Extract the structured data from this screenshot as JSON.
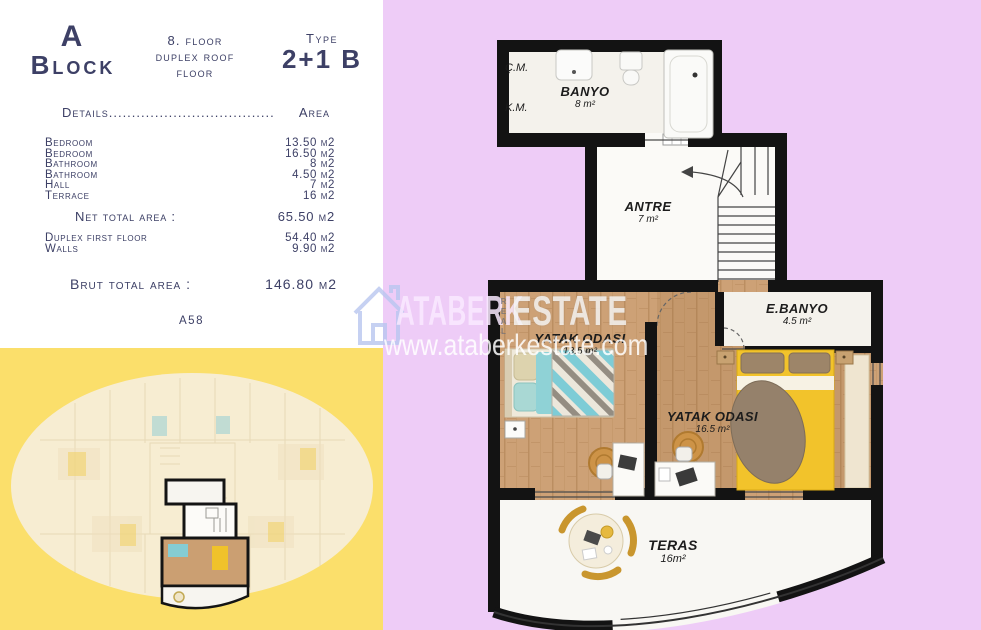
{
  "colors": {
    "background_purple": "#eeccf7",
    "background_yellow": "#fbdf6b",
    "panel_text_navy": "#3d4066",
    "wall_black": "#131313",
    "wood_floor": "#cda176",
    "bed_yellow": "#f2c32b",
    "bed_teal": "#7eccd6",
    "rug_tan": "#cd9347"
  },
  "info_panel": {
    "block_line1": "A",
    "block_line2": "Block",
    "floor_lines": [
      "8. floor",
      "duplex roof",
      "floor"
    ],
    "type_label": "Type",
    "type_value": "2+1 B",
    "details_label": "Details....................................",
    "area_label": "Area",
    "area_rows": [
      {
        "label": "Bedroom",
        "value": "13.50 m2"
      },
      {
        "label": "Bedroom",
        "value": "16.50 m2"
      },
      {
        "label": "Bathroom",
        "value": "8 m2"
      },
      {
        "label": "Bathroom",
        "value": "4.50 m2"
      },
      {
        "label": "Hall",
        "value": "7 m2"
      },
      {
        "label": "Terrace",
        "value": "16 m2"
      }
    ],
    "net_total_label": "Net total area :",
    "net_total_value": "65.50 m2",
    "extra_rows": [
      {
        "label": "Duplex first floor",
        "value": "54.40 m2"
      },
      {
        "label": "Walls",
        "value": "9.90 m2"
      }
    ],
    "brut_total_label": "Brut total area :",
    "brut_total_value": "146.80 m2",
    "unit_code": "A58"
  },
  "floor_plan": {
    "cm": "Ç.M.",
    "km": "K.M.",
    "banyo": {
      "name": "BANYO",
      "area": "8 m²"
    },
    "antre": {
      "name": "ANTRE",
      "area": "7 m²"
    },
    "bedroom_left": {
      "name": "YATAK ODASI",
      "area": "13.5 m²"
    },
    "ebanyo": {
      "name": "E.BANYO",
      "area": "4.5 m²"
    },
    "bedroom_right": {
      "name": "YATAK ODASI",
      "area": "16.5 m²"
    },
    "teras": {
      "name": "TERAS",
      "area": "16m²"
    }
  },
  "watermark": {
    "brand_part1": "ATABERK",
    "brand_middle": "REAL",
    "brand_part2": "ESTATE",
    "url": "www.ataberkestate.com"
  }
}
